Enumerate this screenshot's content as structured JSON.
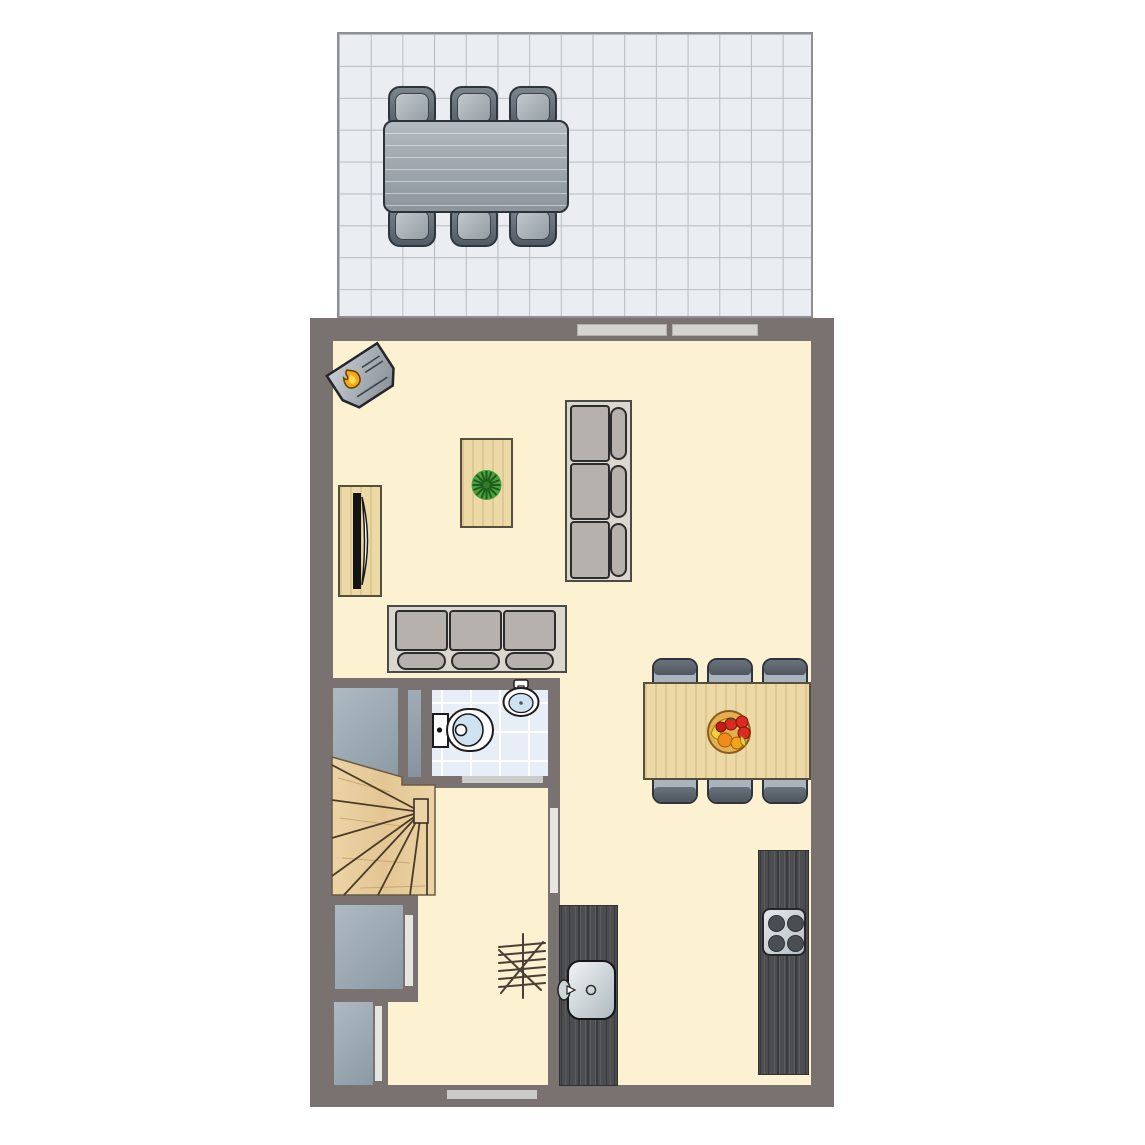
{
  "document": {
    "type": "floor-plan",
    "view": "top-down",
    "visible_text": []
  },
  "palette": {
    "wall": "#7a7270",
    "floor": "#fcf2d1",
    "terrace_tile": "#eaedf1",
    "terrace_grid_line": "#b7bcc4",
    "wood_light": "#ecd9a6",
    "stairs_wood": "#e9d0a2",
    "counter_dark": "#4b4d50",
    "closet_gray": "#9fabb5",
    "bathroom_tile": "#e8eef7",
    "fixture_blue": "#d6e4f2",
    "sofa_frame": "#dbd7cf",
    "sofa_cushion": "#b6b1ac",
    "chair_seat": "#a9b4bf",
    "chair_back": "#5d646c",
    "flame_orange": "#f6a821",
    "flame_yellow": "#ffd94d",
    "plant_green": "#49a33f",
    "door_marker": "#e6e5e1",
    "threshold": "#cbcbc9"
  },
  "areas": {
    "terrace": {
      "name": "terrace",
      "grid_cols": 15,
      "grid_rows": 9
    },
    "living_room": {
      "name": "living-room"
    },
    "bathroom": {
      "name": "bathroom"
    },
    "hallway": {
      "name": "hallway"
    },
    "kitchen": {
      "name": "kitchen"
    },
    "stairs": {
      "name": "winder-staircase"
    }
  },
  "furniture": {
    "outdoor_dining_set": {
      "table": 1,
      "chairs": 6
    },
    "indoor_dining_set": {
      "table": 1,
      "chairs": 6,
      "centerpiece": "fruit-bowl"
    },
    "sofas": [
      {
        "seats": 3,
        "orientation": "vertical"
      },
      {
        "seats": 3,
        "orientation": "horizontal"
      }
    ],
    "coffee_table": {
      "decor": "potted-plant"
    },
    "tv_cabinet": 1,
    "fireplace_stove": 1,
    "closets": 3,
    "toilet": 1,
    "bathroom_sink": 1,
    "kitchen_sink": 1,
    "cooktop_burners": 4,
    "radiator": 1
  },
  "openings": {
    "sliding_door_panels_top": 2,
    "bathroom_door_threshold": 1,
    "entrance_threshold_bottom": 1,
    "interior_door_markers": 4
  }
}
